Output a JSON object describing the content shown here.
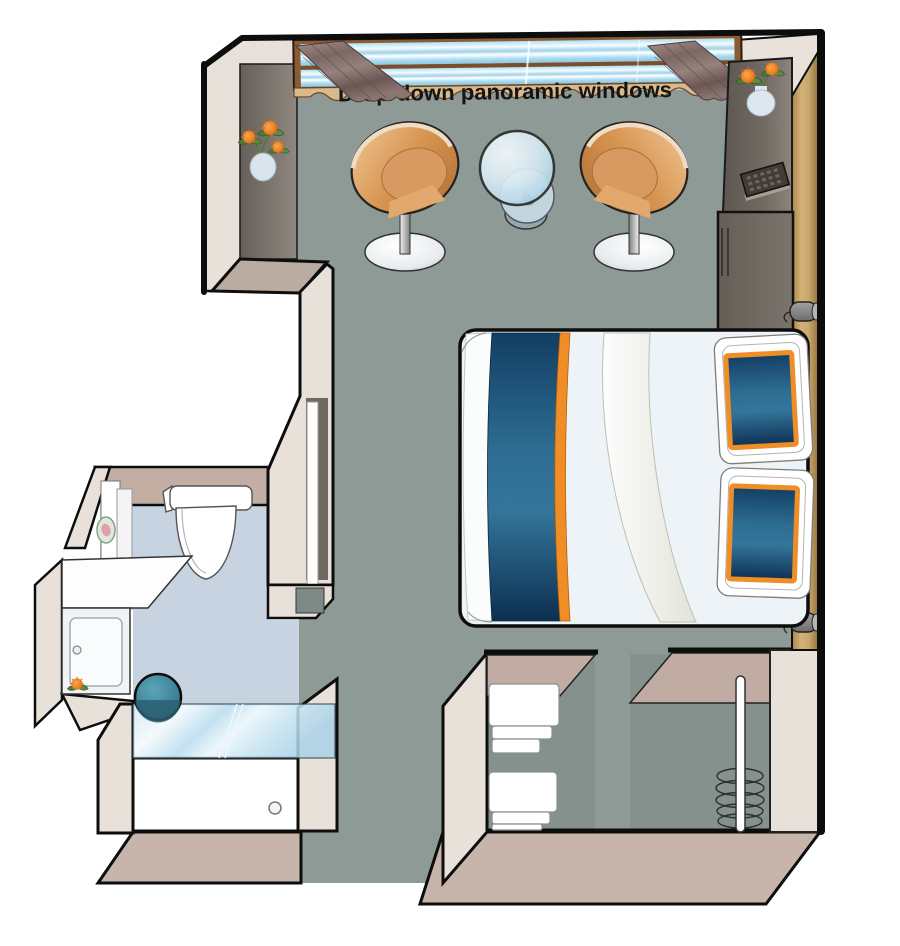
{
  "window": {
    "label": "Drop-down panoramic windows"
  },
  "plan": {
    "kind": "cruise-cabin-floor-plan",
    "rooms": [
      "main-cabin",
      "bathroom",
      "entry-corridor",
      "linen-closet",
      "wardrobe"
    ],
    "furniture": [
      "panoramic-window",
      "curtain-left",
      "curtain-right",
      "wall-flower-vase",
      "desk-flower-vase",
      "tub-chair-left",
      "tub-chair-right",
      "glass-table",
      "desk-unit",
      "remote-control",
      "lower-cabinet",
      "reading-lamp-upper",
      "reading-lamp-lower",
      "double-bed",
      "bed-runner",
      "pillow-upper",
      "pillow-lower",
      "toilet",
      "cosmetic-mirror",
      "vanity-counter",
      "vanity-cabinet",
      "shower-stool",
      "shower-glass",
      "shower-tray",
      "towel-shelf",
      "wardrobe-rail",
      "hangers"
    ]
  },
  "colors": {
    "floor": "#8e9a96",
    "bathroom_floor": "#c8d3e1",
    "wall_face": "#e8e1da",
    "wall_top": "#bbaca2",
    "wall_outline": "#0d0d0d",
    "window_frame_brown": "#8a5c34",
    "window_sill_tan": "#d9ba8c",
    "curtain_mauve": "#8d7772",
    "glass_blue": "#bfe0f0",
    "bed_navy": "#1c4a70",
    "accent_orange": "#ef8d27",
    "chair_orange": "#d59257",
    "headboard_gold": "#c3a067",
    "cabinet_gray": "#6e6862",
    "stool_teal": "#3d7f93",
    "lamp_gray": "#8d8d8d",
    "closet_interior": "#85918d",
    "towel_white": "#ffffff",
    "slab_tan": "#c7b4ab"
  }
}
